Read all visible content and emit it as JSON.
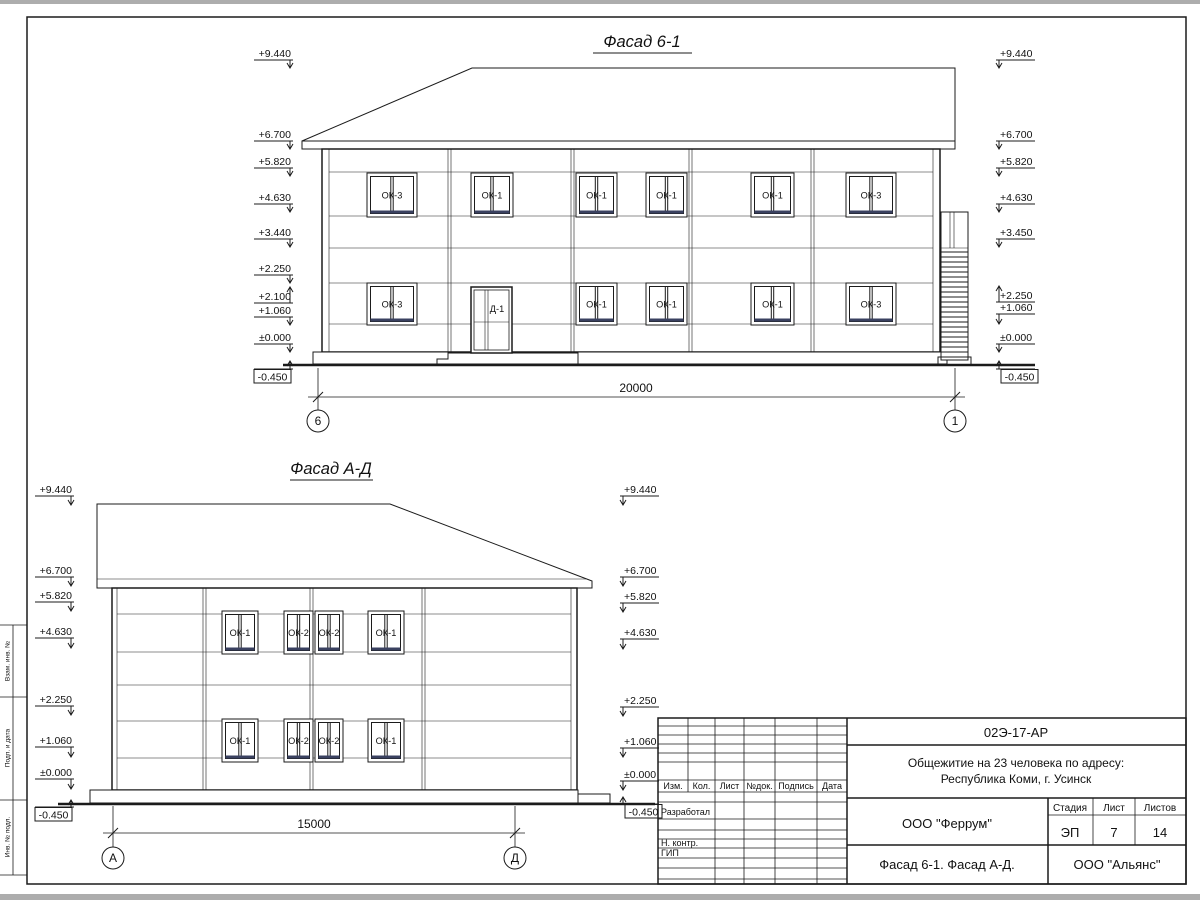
{
  "sheet": {
    "side_labels": [
      "Взам. инв. №",
      "Подп. и дата",
      "Инв. № подл."
    ]
  },
  "facade_top": {
    "title": "Фасад 6-1",
    "marks_left": [
      "+9.440",
      "+6.700",
      "+5.820",
      "+4.630",
      "+3.440",
      "+2.250",
      "+2.100",
      "+1.060",
      "±0.000",
      "-0.450"
    ],
    "marks_right": [
      "+9.440",
      "+6.700",
      "+5.820",
      "+4.630",
      "+3.450",
      "+2.250",
      "+1.060",
      "±0.000",
      "-0.450"
    ],
    "windows_upper": [
      "ОК-3",
      "ОК-1",
      "ОК-1",
      "ОК-1",
      "ОК-1",
      "ОК-3"
    ],
    "windows_lower": [
      "ОК-3",
      "ОК-1",
      "ОК-1",
      "ОК-1",
      "ОК-3"
    ],
    "door_label": "Д-1",
    "dimension": "20000",
    "axis_left": "6",
    "axis_right": "1"
  },
  "facade_bottom": {
    "title": "Фасад А-Д",
    "marks_left": [
      "+9.440",
      "+6.700",
      "+5.820",
      "+4.630",
      "+2.250",
      "+1.060",
      "±0.000",
      "-0.450"
    ],
    "marks_right": [
      "+9.440",
      "+6.700",
      "+5.820",
      "+4.630",
      "+2.250",
      "+1.060",
      "±0.000",
      "-0.450"
    ],
    "windows_upper": [
      "ОК-1",
      "ОК-2",
      "ОК-2",
      "ОК-1"
    ],
    "windows_lower": [
      "ОК-1",
      "ОК-2",
      "ОК-2",
      "ОК-1"
    ],
    "dimension": "15000",
    "axis_left": "А",
    "axis_right": "Д"
  },
  "title_block": {
    "doc_number": "02Э-17-АР",
    "project_line1": "Общежитие на 23 человека по адресу:",
    "project_line2": "Республика Коми, г. Усинск",
    "table_headers": [
      "Изм.",
      "Кол.",
      "Лист",
      "№док.",
      "Подпись",
      "Дата"
    ],
    "row_labels": [
      "Разработал",
      "Н. контр.",
      "ГИП"
    ],
    "org": "ООО \"Феррум\"",
    "stage_header": "Стадия",
    "sheet_header": "Лист",
    "sheets_header": "Листов",
    "stage": "ЭП",
    "sheet_no": "7",
    "sheets_total": "14",
    "drawing_title": "Фасад 6-1. Фасад  А-Д.",
    "contractor": "ООО \"Альянс\""
  }
}
